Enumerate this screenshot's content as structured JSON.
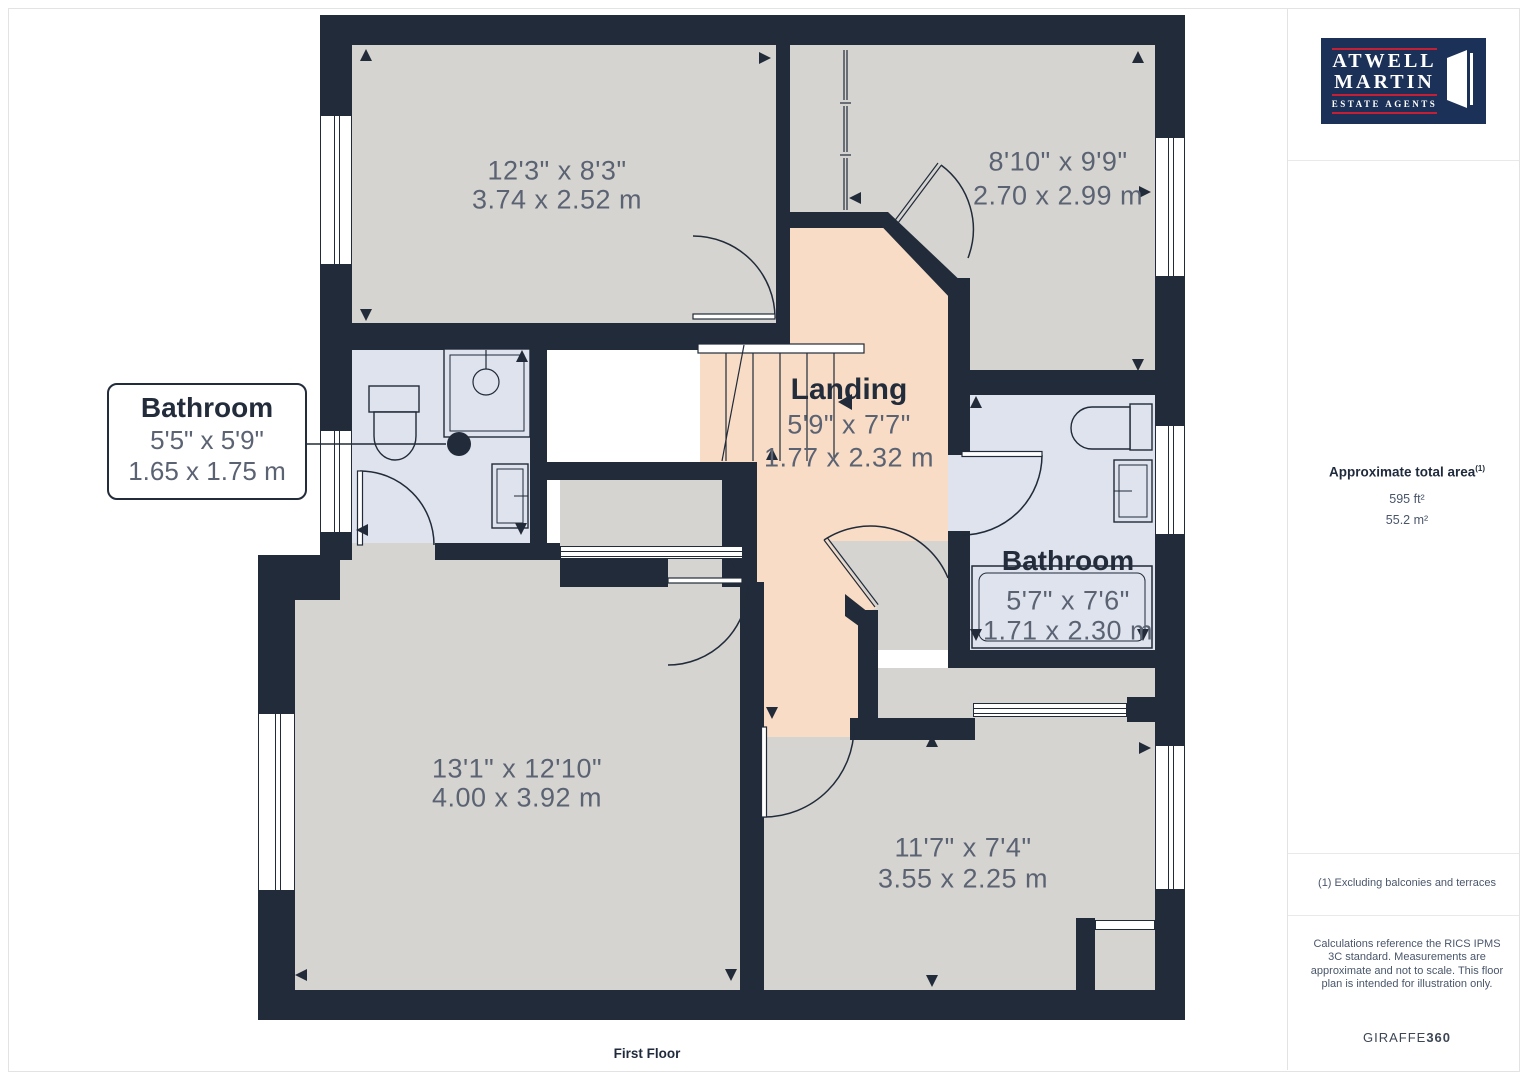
{
  "page": {
    "floor_label": "First Floor"
  },
  "rooms": {
    "bedroom_top_left": {
      "imperial": "12'3\" x 8'3\"",
      "metric": "3.74 x 2.52 m"
    },
    "bedroom_top_right": {
      "imperial": "8'10\" x 9'9\"",
      "metric": "2.70 x 2.99 m"
    },
    "landing": {
      "name": "Landing",
      "imperial": "5'9\" x 7'7\"",
      "metric": "1.77 x 2.32 m"
    },
    "bathroom_left": {
      "name": "Bathroom",
      "imperial": "5'5\" x 5'9\"",
      "metric": "1.65 x 1.75 m"
    },
    "bathroom_right": {
      "name": "Bathroom",
      "imperial": "5'7\" x 7'6\"",
      "metric": "1.71 x 2.30 m"
    },
    "bedroom_bottom_left": {
      "imperial": "13'1\" x 12'10\"",
      "metric": "4.00 x 3.92 m"
    },
    "bedroom_bottom_right": {
      "imperial": "11'7\" x 7'4\"",
      "metric": "3.55 x 2.25 m"
    }
  },
  "sidebar": {
    "logo": {
      "line1": "ATWELL",
      "line2": "MARTIN",
      "line3": "ESTATE AGENTS"
    },
    "area": {
      "title": "Approximate total area",
      "footnote_marker": "(1)",
      "imperial": "595 ft²",
      "metric": "55.2 m²"
    },
    "footnote": "(1) Excluding balconies and terraces",
    "disclaimer": "Calculations reference the RICS IPMS 3C standard. Measurements are approximate and not to scale. This floor plan is intended for illustration only.",
    "brand": {
      "name": "GIRAFFE",
      "suffix": "360"
    }
  },
  "colors": {
    "wall": "#212b39",
    "room_gray": "#d5d4d1",
    "landing_peach": "#f8dcc6",
    "bathroom_blue": "#dfe3ee",
    "logo_navy": "#1c3158",
    "logo_red": "#c51f35",
    "dim_text": "#5b6373"
  }
}
